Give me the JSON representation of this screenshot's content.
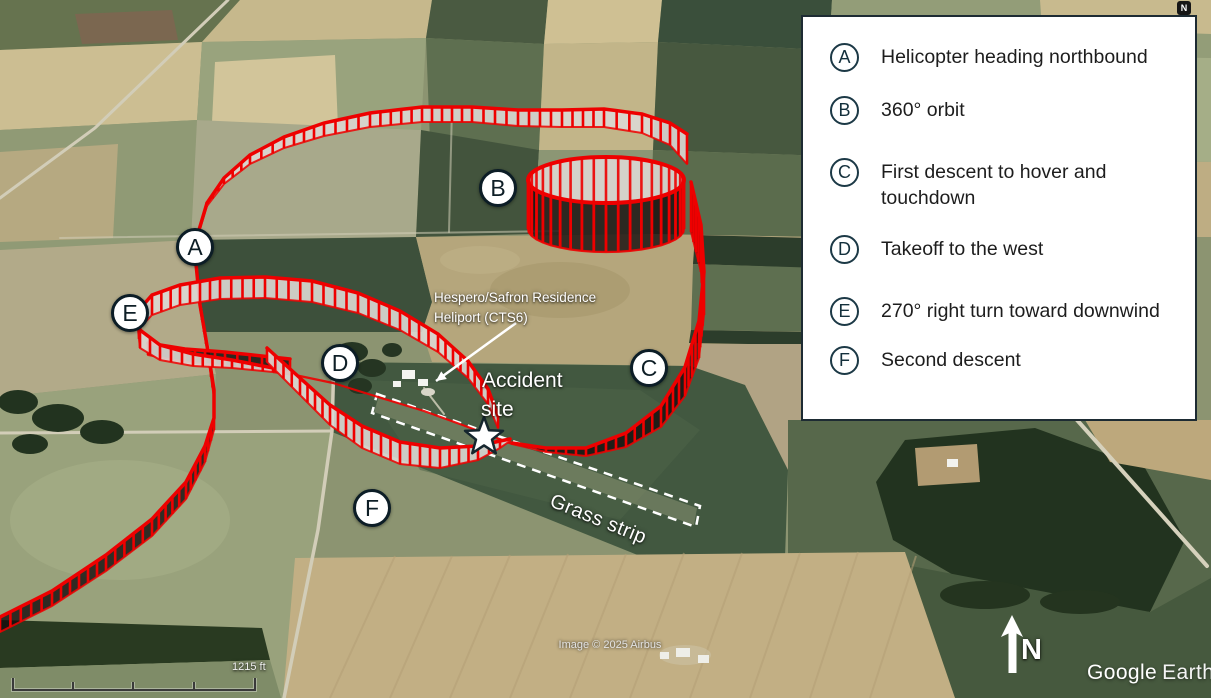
{
  "app": {
    "name": "Google Earth"
  },
  "legend": {
    "items": [
      {
        "id": "A",
        "label": "Helicopter heading northbound"
      },
      {
        "id": "B",
        "label": "360° orbit"
      },
      {
        "id": "C",
        "label": "First descent to hover and touchdown"
      },
      {
        "id": "D",
        "label": "Takeoff to the west"
      },
      {
        "id": "E",
        "label": "270° right turn toward downwind"
      },
      {
        "id": "F",
        "label": "Second descent"
      }
    ]
  },
  "map": {
    "markers": [
      {
        "id": "A",
        "x": 195,
        "y": 247
      },
      {
        "id": "B",
        "x": 498,
        "y": 188
      },
      {
        "id": "C",
        "x": 649,
        "y": 368
      },
      {
        "id": "D",
        "x": 340,
        "y": 363
      },
      {
        "id": "E",
        "x": 130,
        "y": 313
      },
      {
        "id": "F",
        "x": 372,
        "y": 508
      }
    ],
    "labels": {
      "heliport_line1": "Hespero/Safron Residence",
      "heliport_line2": "Heliport (CTS6)",
      "accident_line1": "Accident",
      "accident_line2": "site",
      "grass_strip": "Grass strip",
      "north": "N",
      "compass": "N"
    },
    "star": {
      "x": 484,
      "y": 437,
      "r": 20
    },
    "strip_outline": [
      [
        377,
        394
      ],
      [
        700,
        506
      ],
      [
        696,
        527
      ],
      [
        372,
        413
      ]
    ],
    "heliport_arrow": {
      "from": [
        516,
        323
      ],
      "to": [
        436,
        381
      ]
    }
  },
  "flight_path": {
    "color": "#ee0000",
    "fill_dark": "rgba(20,13,13,0.8)",
    "fill_light": "rgba(219,216,212,0.9)",
    "segments": [
      {
        "name": "entry-south-ribbon",
        "fill": "dark",
        "pts": [
          [
            0,
            632,
            15
          ],
          [
            52,
            606,
            15
          ],
          [
            106,
            571,
            16
          ],
          [
            152,
            536,
            17
          ],
          [
            186,
            499,
            17
          ],
          [
            205,
            462,
            16
          ],
          [
            214,
            430,
            12
          ],
          [
            214,
            398,
            8
          ],
          [
            208,
            356,
            5
          ],
          [
            200,
            308,
            3
          ],
          [
            196,
            266,
            2
          ],
          [
            199,
            232,
            2
          ],
          [
            207,
            206,
            3
          ]
        ]
      },
      {
        "name": "northbound-arc-ribbon",
        "fill": "light",
        "pts": [
          [
            207,
            206,
            3
          ],
          [
            224,
            184,
            6
          ],
          [
            250,
            164,
            9
          ],
          [
            284,
            148,
            11
          ],
          [
            324,
            136,
            13
          ],
          [
            370,
            127,
            14
          ],
          [
            422,
            122,
            15
          ],
          [
            472,
            122,
            15
          ],
          [
            518,
            126,
            16
          ],
          [
            562,
            127,
            17
          ],
          [
            604,
            127,
            18
          ],
          [
            642,
            133,
            19
          ],
          [
            670,
            145,
            22
          ],
          [
            687,
            164,
            30
          ]
        ]
      },
      {
        "name": "first-descent-ribbon",
        "fill": "dark",
        "pts": [
          [
            691,
            232,
            50
          ],
          [
            701,
            272,
            47
          ],
          [
            704,
            315,
            43
          ],
          [
            699,
            358,
            37
          ],
          [
            685,
            396,
            29
          ],
          [
            661,
            427,
            21
          ],
          [
            626,
            447,
            14
          ],
          [
            586,
            456,
            8
          ],
          [
            546,
            452,
            4
          ],
          [
            512,
            444,
            1
          ]
        ]
      },
      {
        "name": "takeoff-west-track",
        "line": true,
        "pts": [
          [
            512,
            444
          ],
          [
            468,
            427
          ],
          [
            424,
            411
          ],
          [
            378,
            397
          ],
          [
            333,
            383
          ],
          [
            295,
            375
          ],
          [
            273,
            372
          ]
        ]
      },
      {
        "name": "loop-underside-ribbon",
        "fill": "dark",
        "pts": [
          [
            148,
            355,
            12
          ],
          [
            185,
            362,
            13
          ],
          [
            225,
            366,
            14
          ],
          [
            262,
            370,
            14
          ],
          [
            290,
            372,
            13
          ]
        ]
      },
      {
        "name": "downwind-loop-ribbon",
        "fill": "light",
        "pts": [
          [
            273,
            372,
            4
          ],
          [
            232,
            368,
            8
          ],
          [
            193,
            366,
            12
          ],
          [
            160,
            360,
            15
          ],
          [
            140,
            348,
            18
          ],
          [
            138,
            330,
            19
          ],
          [
            152,
            315,
            20
          ],
          [
            180,
            305,
            20
          ],
          [
            220,
            299,
            21
          ],
          [
            265,
            298,
            21
          ],
          [
            312,
            302,
            21
          ],
          [
            358,
            313,
            20
          ],
          [
            400,
            330,
            19
          ],
          [
            438,
            352,
            18
          ],
          [
            468,
            378,
            17
          ],
          [
            488,
            404,
            15
          ],
          [
            498,
            428,
            12
          ]
        ]
      },
      {
        "name": "second-descent-ribbon",
        "fill": "light",
        "pts": [
          [
            267,
            362,
            14
          ],
          [
            300,
            395,
            17
          ],
          [
            330,
            425,
            20
          ],
          [
            362,
            448,
            22
          ],
          [
            400,
            464,
            22
          ],
          [
            440,
            468,
            20
          ],
          [
            478,
            460,
            14
          ],
          [
            500,
            448,
            7
          ],
          [
            510,
            441,
            2
          ]
        ]
      }
    ],
    "orbit": {
      "cx": 606,
      "cyTop": 180,
      "cyBottom": 229,
      "rx": 78,
      "ry": 23
    }
  },
  "footer": {
    "scale_label": "1215 ft",
    "credit": "Image © 2025 Airbus",
    "logo_google": "Google",
    "logo_earth": "Earth"
  },
  "colors": {
    "path_red": "#ee0000",
    "legend_circle_border": "#1c3946",
    "marker_border": "#0c1d26",
    "legend_background": "#ffffff"
  }
}
